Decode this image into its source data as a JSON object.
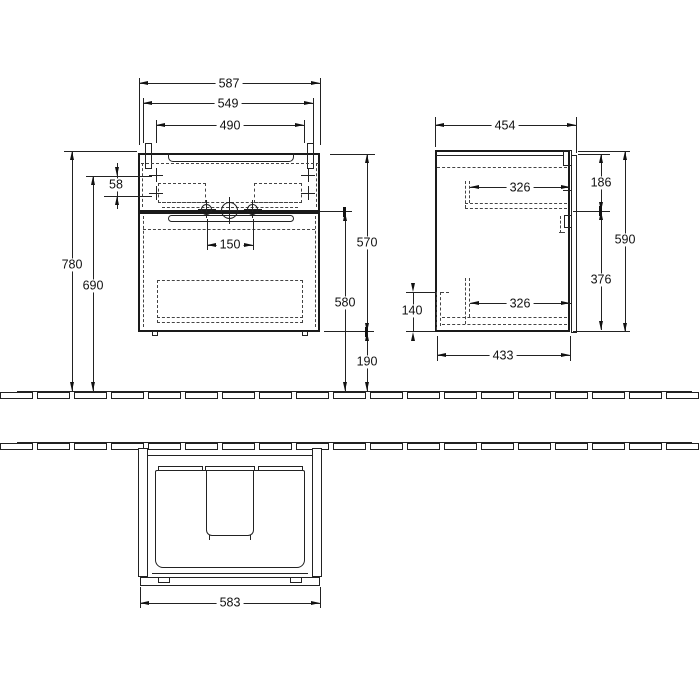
{
  "dims": {
    "front": {
      "overall_width": "587",
      "mount_width": "549",
      "hole_spacing_width": "490",
      "height_overall": "780",
      "height_mount_holes": "690",
      "mount_hole_gap": "58",
      "unit_height": "570",
      "basin_underside_height": "580",
      "floor_clearance": "190",
      "tap_hole_spacing": "150"
    },
    "side": {
      "overall_depth": "454",
      "upper_rail_depth": "326",
      "upper_front_height": "186",
      "unit_height": "590",
      "lower_section_height": "376",
      "lower_rail_depth": "326",
      "siphon_recess_height": "140",
      "body_depth": "433"
    },
    "top": {
      "overall_width": "583"
    }
  }
}
